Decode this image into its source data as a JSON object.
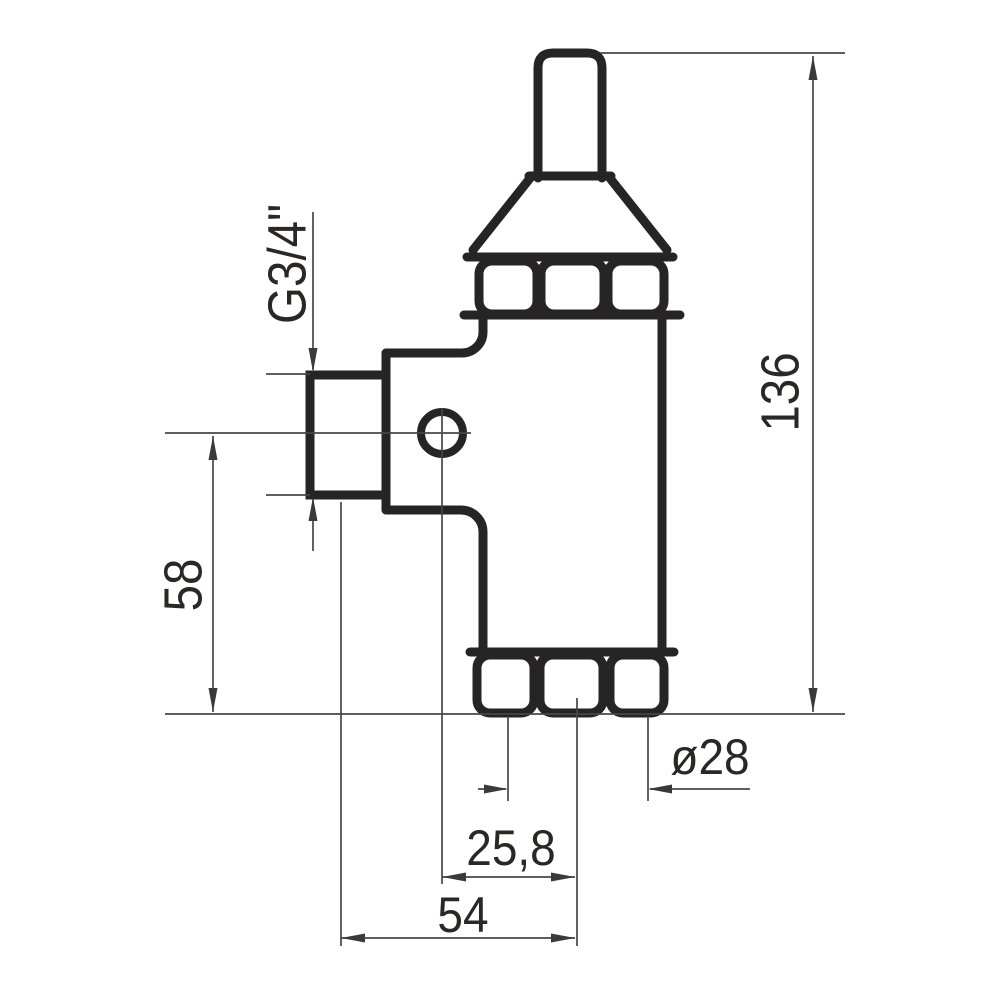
{
  "drawing": {
    "kind": "technical-drawing-valve-side-view",
    "background_color": "#ffffff",
    "outline_color": "#272425",
    "dimension_line_color": "#474747",
    "text_color": "#2a2726",
    "labels": {
      "thread": "G3/4\"",
      "height_side": "58",
      "height_total": "136",
      "diameter": "ø28",
      "offset_center": "25,8",
      "width_total": "54"
    },
    "dimensions": [
      {
        "id": "thread-size",
        "label": "G3/4\"",
        "orientation": "rotated-vertical",
        "measures": "inlet port thread"
      },
      {
        "id": "height-58",
        "label": "58",
        "orientation": "rotated-vertical",
        "measures": "port axis to bottom"
      },
      {
        "id": "height-136",
        "label": "136",
        "orientation": "rotated-vertical",
        "measures": "overall height"
      },
      {
        "id": "diameter-28",
        "label": "ø28",
        "orientation": "horizontal",
        "measures": "lower connection diameter"
      },
      {
        "id": "offset-25-8",
        "label": "25,8",
        "orientation": "horizontal",
        "measures": "hole axis to body axis"
      },
      {
        "id": "width-54",
        "label": "54",
        "orientation": "horizontal",
        "measures": "port to body axis"
      }
    ]
  }
}
